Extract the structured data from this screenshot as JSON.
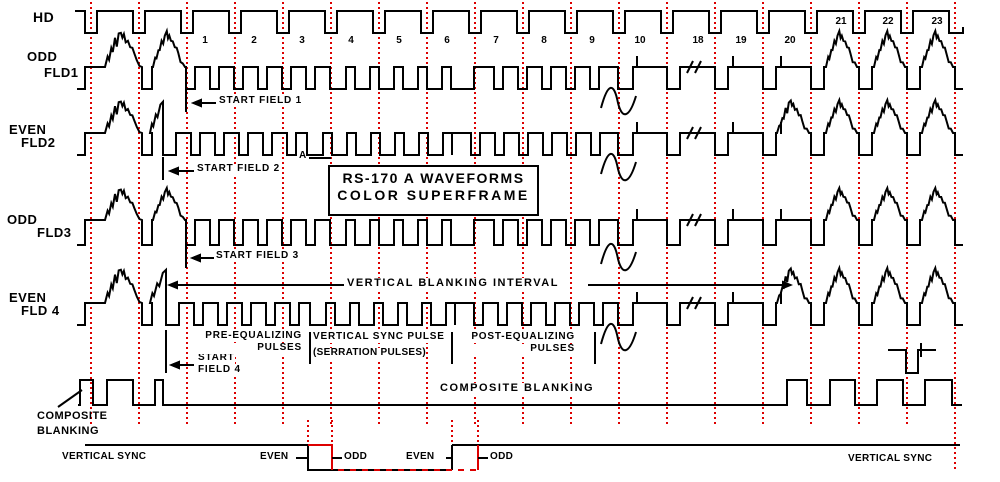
{
  "title_box": {
    "line1": "RS-170 A  WAVEFORMS",
    "line2": "COLOR SUPERFRAME"
  },
  "colors": {
    "ink": "#000000",
    "grid_red": "#dd0000",
    "background": "#ffffff"
  },
  "rows": {
    "hd": "HD",
    "fld1": {
      "type": "ODD",
      "name": "FLD1"
    },
    "fld2": {
      "type": "EVEN",
      "name": "FLD2"
    },
    "fld3": {
      "type": "ODD",
      "name": "FLD3"
    },
    "fld4": {
      "type": "EVEN",
      "name": "FLD 4"
    }
  },
  "line_numbers": [
    {
      "n": "1",
      "x": 205,
      "top": 36
    },
    {
      "n": "2",
      "x": 254,
      "top": 36
    },
    {
      "n": "3",
      "x": 302,
      "top": 36
    },
    {
      "n": "4",
      "x": 351,
      "top": 36
    },
    {
      "n": "5",
      "x": 399,
      "top": 36
    },
    {
      "n": "6",
      "x": 447,
      "top": 36
    },
    {
      "n": "7",
      "x": 496,
      "top": 36
    },
    {
      "n": "8",
      "x": 544,
      "top": 36
    },
    {
      "n": "9",
      "x": 592,
      "top": 36
    },
    {
      "n": "10",
      "x": 640,
      "top": 36
    },
    {
      "n": "18",
      "x": 698,
      "top": 36
    },
    {
      "n": "19",
      "x": 741,
      "top": 36
    },
    {
      "n": "20",
      "x": 790,
      "top": 36
    },
    {
      "n": "21",
      "x": 841,
      "top": 17
    },
    {
      "n": "22",
      "x": 888,
      "top": 17
    },
    {
      "n": "23",
      "x": 937,
      "top": 17
    }
  ],
  "annotations": {
    "start_field_1": "START FIELD 1",
    "start_field_2": "START FIELD 2",
    "start_field_3": "START FIELD 3",
    "start_field_4_l1": "START",
    "start_field_4_l2": "FIELD 4",
    "point_a": "A",
    "vbi": "VERTICAL BLANKING INTERVAL",
    "pre_eq_l1": "PRE-EQUALIZING",
    "pre_eq_l2": "PULSES",
    "vsync_pulse_l1": "VERTICAL SYNC PULSE",
    "vsync_pulse_l2": "(SERRATION PULSES)",
    "post_eq_l1": "POST-EQUALIZING",
    "post_eq_l2": "PULSES",
    "composite_center": "COMPOSITE  BLANKING",
    "composite_l1": "COMPOSITE",
    "composite_l2": "BLANKING",
    "vsync_left": "VERTICAL SYNC",
    "vsync_right": "VERTICAL SYNC",
    "even_1": "EVEN",
    "odd_1": "ODD",
    "even_2": "EVEN",
    "odd_2": "ODD"
  },
  "geometry": {
    "grid": {
      "x_start": 91,
      "spacing": 48,
      "count": 19,
      "y1": 2,
      "y2": 424,
      "tall_x": 955,
      "tall_y2": 470,
      "marker_xs": [
        308,
        332,
        452,
        478
      ],
      "marker_y": [
        420,
        446
      ]
    },
    "hd": {
      "high": 11,
      "low": 33,
      "x_start": 75,
      "x_end": 963,
      "pulse_centers": [
        91,
        139,
        187,
        235,
        283,
        331,
        379,
        427,
        475,
        523,
        571,
        619,
        667,
        715,
        763,
        811,
        859,
        907
      ],
      "half_width": 6,
      "last_fall": 949
    },
    "fields": [
      {
        "key": "fld1",
        "v": 31,
        "b": 67,
        "s": 89,
        "parity": "odd",
        "eq_dips": [
          186,
          210,
          234,
          258,
          282,
          306
        ],
        "serr": [
          330,
          474
        ],
        "serr_pulses": [
          346,
          370,
          394,
          418,
          442
        ],
        "post_dips": [
          494,
          518,
          542,
          566,
          590
        ]
      },
      {
        "key": "fld2",
        "v": 100,
        "b": 133,
        "s": 155,
        "parity": "even",
        "cut": 163,
        "eq_dips": [
          191,
          215,
          239,
          263,
          287
        ],
        "serr": [
          307,
          452
        ],
        "serr_pulses": [
          323,
          347,
          371,
          395,
          419,
          443
        ],
        "post_dips": [
          471,
          495,
          519,
          543,
          567,
          591
        ]
      },
      {
        "key": "fld3",
        "v": 188,
        "b": 220,
        "s": 245,
        "parity": "odd",
        "eq_dips": [
          186,
          210,
          234,
          258,
          282,
          306
        ],
        "serr": [
          330,
          474
        ],
        "serr_pulses": [
          346,
          370,
          394,
          418,
          442
        ],
        "post_dips": [
          494,
          518,
          542,
          566,
          590
        ]
      },
      {
        "key": "fld4",
        "v": 268,
        "b": 303,
        "s": 325,
        "parity": "even",
        "cut": 166,
        "eq_dips": [
          194,
          218,
          242,
          266,
          290
        ],
        "serr": [
          310,
          455
        ],
        "serr_pulses": [
          326,
          350,
          374,
          398,
          422,
          446
        ],
        "post_dips": [
          474,
          498,
          522,
          546,
          570,
          594
        ]
      }
    ],
    "right_dips": [
      667,
      715,
      763,
      811,
      859,
      907
    ],
    "ticks_x": [
      637,
      733,
      781
    ],
    "slash_x": 687,
    "squiggle_x": 601,
    "composite": {
      "top": 380,
      "base": 405,
      "x_start": 78,
      "x_end": 962,
      "highs": [
        [
          80,
          93
        ],
        [
          107,
          133
        ],
        [
          155,
          163
        ],
        [
          787,
          807
        ],
        [
          830,
          855
        ],
        [
          877,
          903
        ],
        [
          925,
          952
        ]
      ],
      "pointer": [
        58,
        407,
        82,
        390
      ]
    },
    "vsync_band": {
      "high": 445,
      "low": 470,
      "line_start": 85,
      "line_end": 960,
      "box1": [
        308,
        332
      ],
      "box2": [
        452,
        478
      ],
      "tick_segs": [
        [
          296,
          308
        ],
        [
          332,
          342
        ],
        [
          446,
          452
        ],
        [
          478,
          488
        ]
      ],
      "tick_y": 458
    },
    "sf_marks": [
      {
        "tick": [
          186,
          90,
          112
        ],
        "arrow_y": 103,
        "tip": 191,
        "tail": 216
      },
      {
        "tick": [
          163,
          157,
          180
        ],
        "arrow_y": 171,
        "tip": 168,
        "tail": 194
      },
      {
        "tick": [
          186,
          246,
          268
        ],
        "arrow_y": 258,
        "tip": 190,
        "tail": 214
      },
      {
        "tick": [
          166,
          330,
          373
        ],
        "arrow_y": 365,
        "tip": 169,
        "tail": 194
      }
    ],
    "vbi_arrow": {
      "y": 285,
      "tip_left": 167,
      "tip_right": 793,
      "seg1": [
        177,
        344
      ],
      "seg2": [
        588,
        783
      ]
    },
    "bars_x": [
      310,
      452,
      595
    ],
    "bars_y": [
      332,
      364
    ],
    "a_line": [
      309,
      158,
      331,
      158
    ],
    "burst_detail": {
      "d": "M888,350H906V373H918V350H936",
      "tick": [
        921,
        343,
        357
      ]
    }
  }
}
